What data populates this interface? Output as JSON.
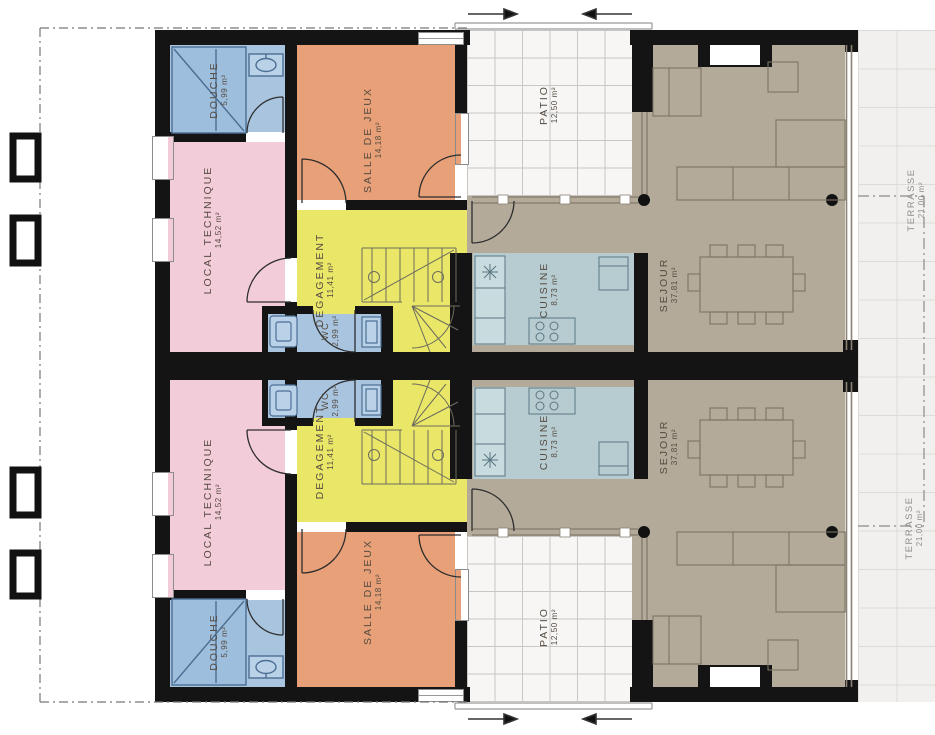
{
  "plan": {
    "type": "architectural floor plan, two mirrored dwelling units",
    "units": [
      "unit-top",
      "unit-bottom"
    ]
  },
  "rooms": {
    "douche": {
      "label": "DOUCHE",
      "area": "5,99 m²"
    },
    "local_technique": {
      "label": "LOCAL TECHNIQUE",
      "area": "14,52 m²"
    },
    "salle_de_jeux": {
      "label": "SALLE DE JEUX",
      "area": "14,18 m²"
    },
    "degagement": {
      "label": "DEGAGEMENT",
      "area": "11,41 m²"
    },
    "wc": {
      "label": "WC",
      "area": "2,99 m²"
    },
    "cuisine": {
      "label": "CUISINE",
      "area": "8,73 m²"
    },
    "sejour": {
      "label": "SEJOUR",
      "area": "37,81 m²"
    },
    "patio": {
      "label": "PATIO",
      "area": "12,50 m²"
    },
    "terrasse": {
      "label": "TERRASSE",
      "area": "21,00 m²"
    }
  },
  "palette": {
    "wall": "#141414",
    "douche_wc_blue": "#a9c4de",
    "local_technique_pink": "#f3ccd9",
    "salle_de_jeux_orange": "#e7a077",
    "degagement_yellow": "#eae668",
    "cuisine_blue_gray": "#b7ccd1",
    "sejour_taupe": "#b3aa9a",
    "patio_tile": "#f7f6f5",
    "terrasse_tile": "#f1f0ee"
  },
  "icons": {
    "entrance_arrow_right": "→",
    "entrance_arrow_left": "←"
  }
}
